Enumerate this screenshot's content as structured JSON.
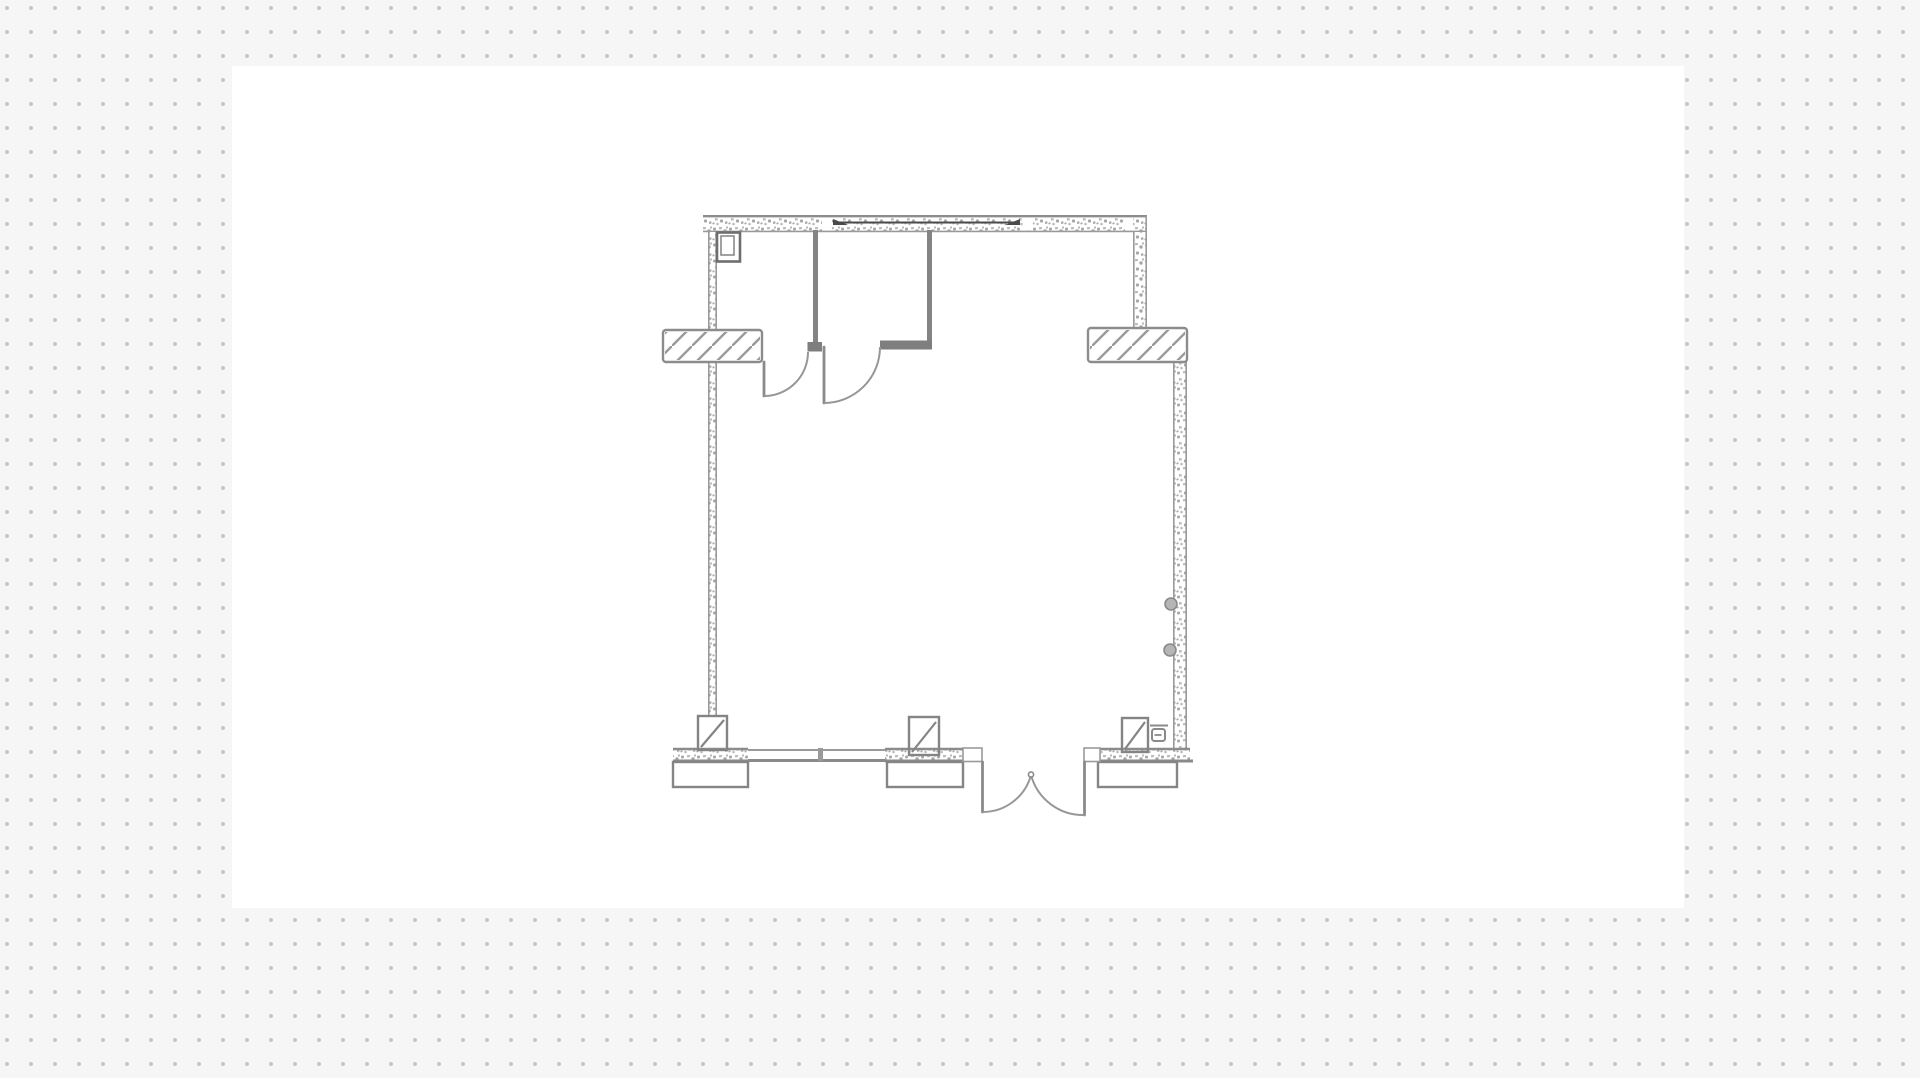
{
  "app": {
    "view": "floor-plan-design-canvas",
    "visible_text": "none"
  },
  "canvas": {
    "x": 232,
    "y": 66,
    "width": 1452,
    "height": 842,
    "background": "#ffffff"
  },
  "grid": {
    "spacing_px": 24,
    "offset_x": 7,
    "offset_y": 8,
    "dot_radius_px": 2,
    "dot_color": "#c7c7c7",
    "page_background": "#f6f6f6"
  },
  "colors": {
    "page_bg": "#f6f6f6",
    "grid_dot": "#c7c7c7",
    "canvas_bg": "#ffffff",
    "wall_line": "#8c8c8c",
    "wall_edge": "#9a9a9a",
    "hatch_line": "#9a9a9a",
    "partition": "#848484",
    "stub_wall": "#7e7e7e",
    "door_line": "#8a8a8a",
    "arc_line": "#979797",
    "footing_line": "#858585",
    "fixture_line": "#6e6e6e",
    "glazing_line": "#4a4a4a",
    "socket_fill": "#b5b5b5",
    "speckle_a": "#a6a6a6",
    "speckle_b": "#bdbdbd"
  },
  "floor_plan": {
    "elements": [
      {
        "name": "top-exterior-wall",
        "type": "masonry wall with speckle hatch"
      },
      {
        "name": "top-wall-window",
        "type": "in-wall glazing line with end wedges and jamb gaps"
      },
      {
        "name": "left-exterior-wall",
        "type": "masonry wall"
      },
      {
        "name": "right-exterior-wall-upper",
        "type": "masonry wall (inset jog)"
      },
      {
        "name": "right-exterior-wall-lower",
        "type": "masonry wall (outset jog)"
      },
      {
        "name": "left-window",
        "type": "window symbol, diagonal hatch sill"
      },
      {
        "name": "right-window",
        "type": "window symbol, diagonal hatch sill"
      },
      {
        "name": "interior-partition-left",
        "type": "stud partition wall"
      },
      {
        "name": "interior-partition-right",
        "type": "stud partition wall with stub"
      },
      {
        "name": "interior-door-left",
        "type": "single swing door"
      },
      {
        "name": "interior-door-right",
        "type": "single swing door"
      },
      {
        "name": "bottom-wall-window",
        "type": "low window / sill band with mullion"
      },
      {
        "name": "entry-double-door",
        "type": "double swing entry door"
      },
      {
        "name": "column-left",
        "type": "pier with diagonal marker and footing"
      },
      {
        "name": "column-middle",
        "type": "pier with diagonal marker and footing"
      },
      {
        "name": "column-right",
        "type": "pier with diagonal marker and footing"
      },
      {
        "name": "flue-box",
        "type": "small shaft/flue square at top-left interior corner"
      },
      {
        "name": "wall-sockets",
        "type": "two circular fittings on lower right wall"
      },
      {
        "name": "switch-symbol",
        "type": "small electrical symbol beside right column"
      }
    ]
  }
}
